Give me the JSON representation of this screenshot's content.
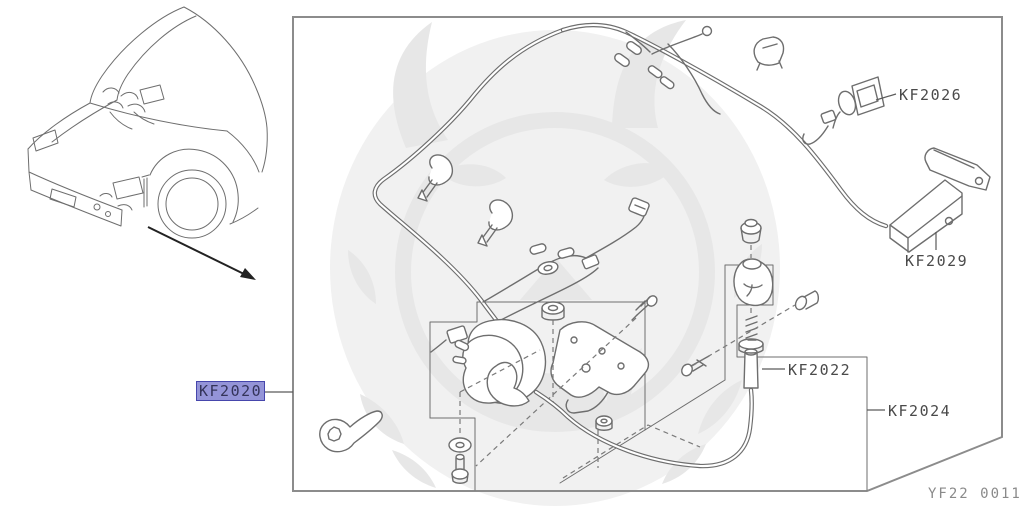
{
  "diagram_code": {
    "text": "YF22 0011"
  },
  "labels": {
    "kf2020": {
      "text": "KF2020",
      "selected": true
    },
    "kf2022": {
      "text": "KF2022",
      "selected": false
    },
    "kf2024": {
      "text": "KF2024",
      "selected": false
    },
    "kf2026": {
      "text": "KF2026",
      "selected": false
    },
    "kf2029": {
      "text": "KF2029",
      "selected": false
    }
  },
  "colors": {
    "highlight_fill": "#9494d8",
    "highlight_border": "#4646ac",
    "label_text": "#4a4a4a",
    "line_art": "#6e6e6e",
    "frame": "#8c8c8c",
    "code_text": "#8a8a8a"
  }
}
